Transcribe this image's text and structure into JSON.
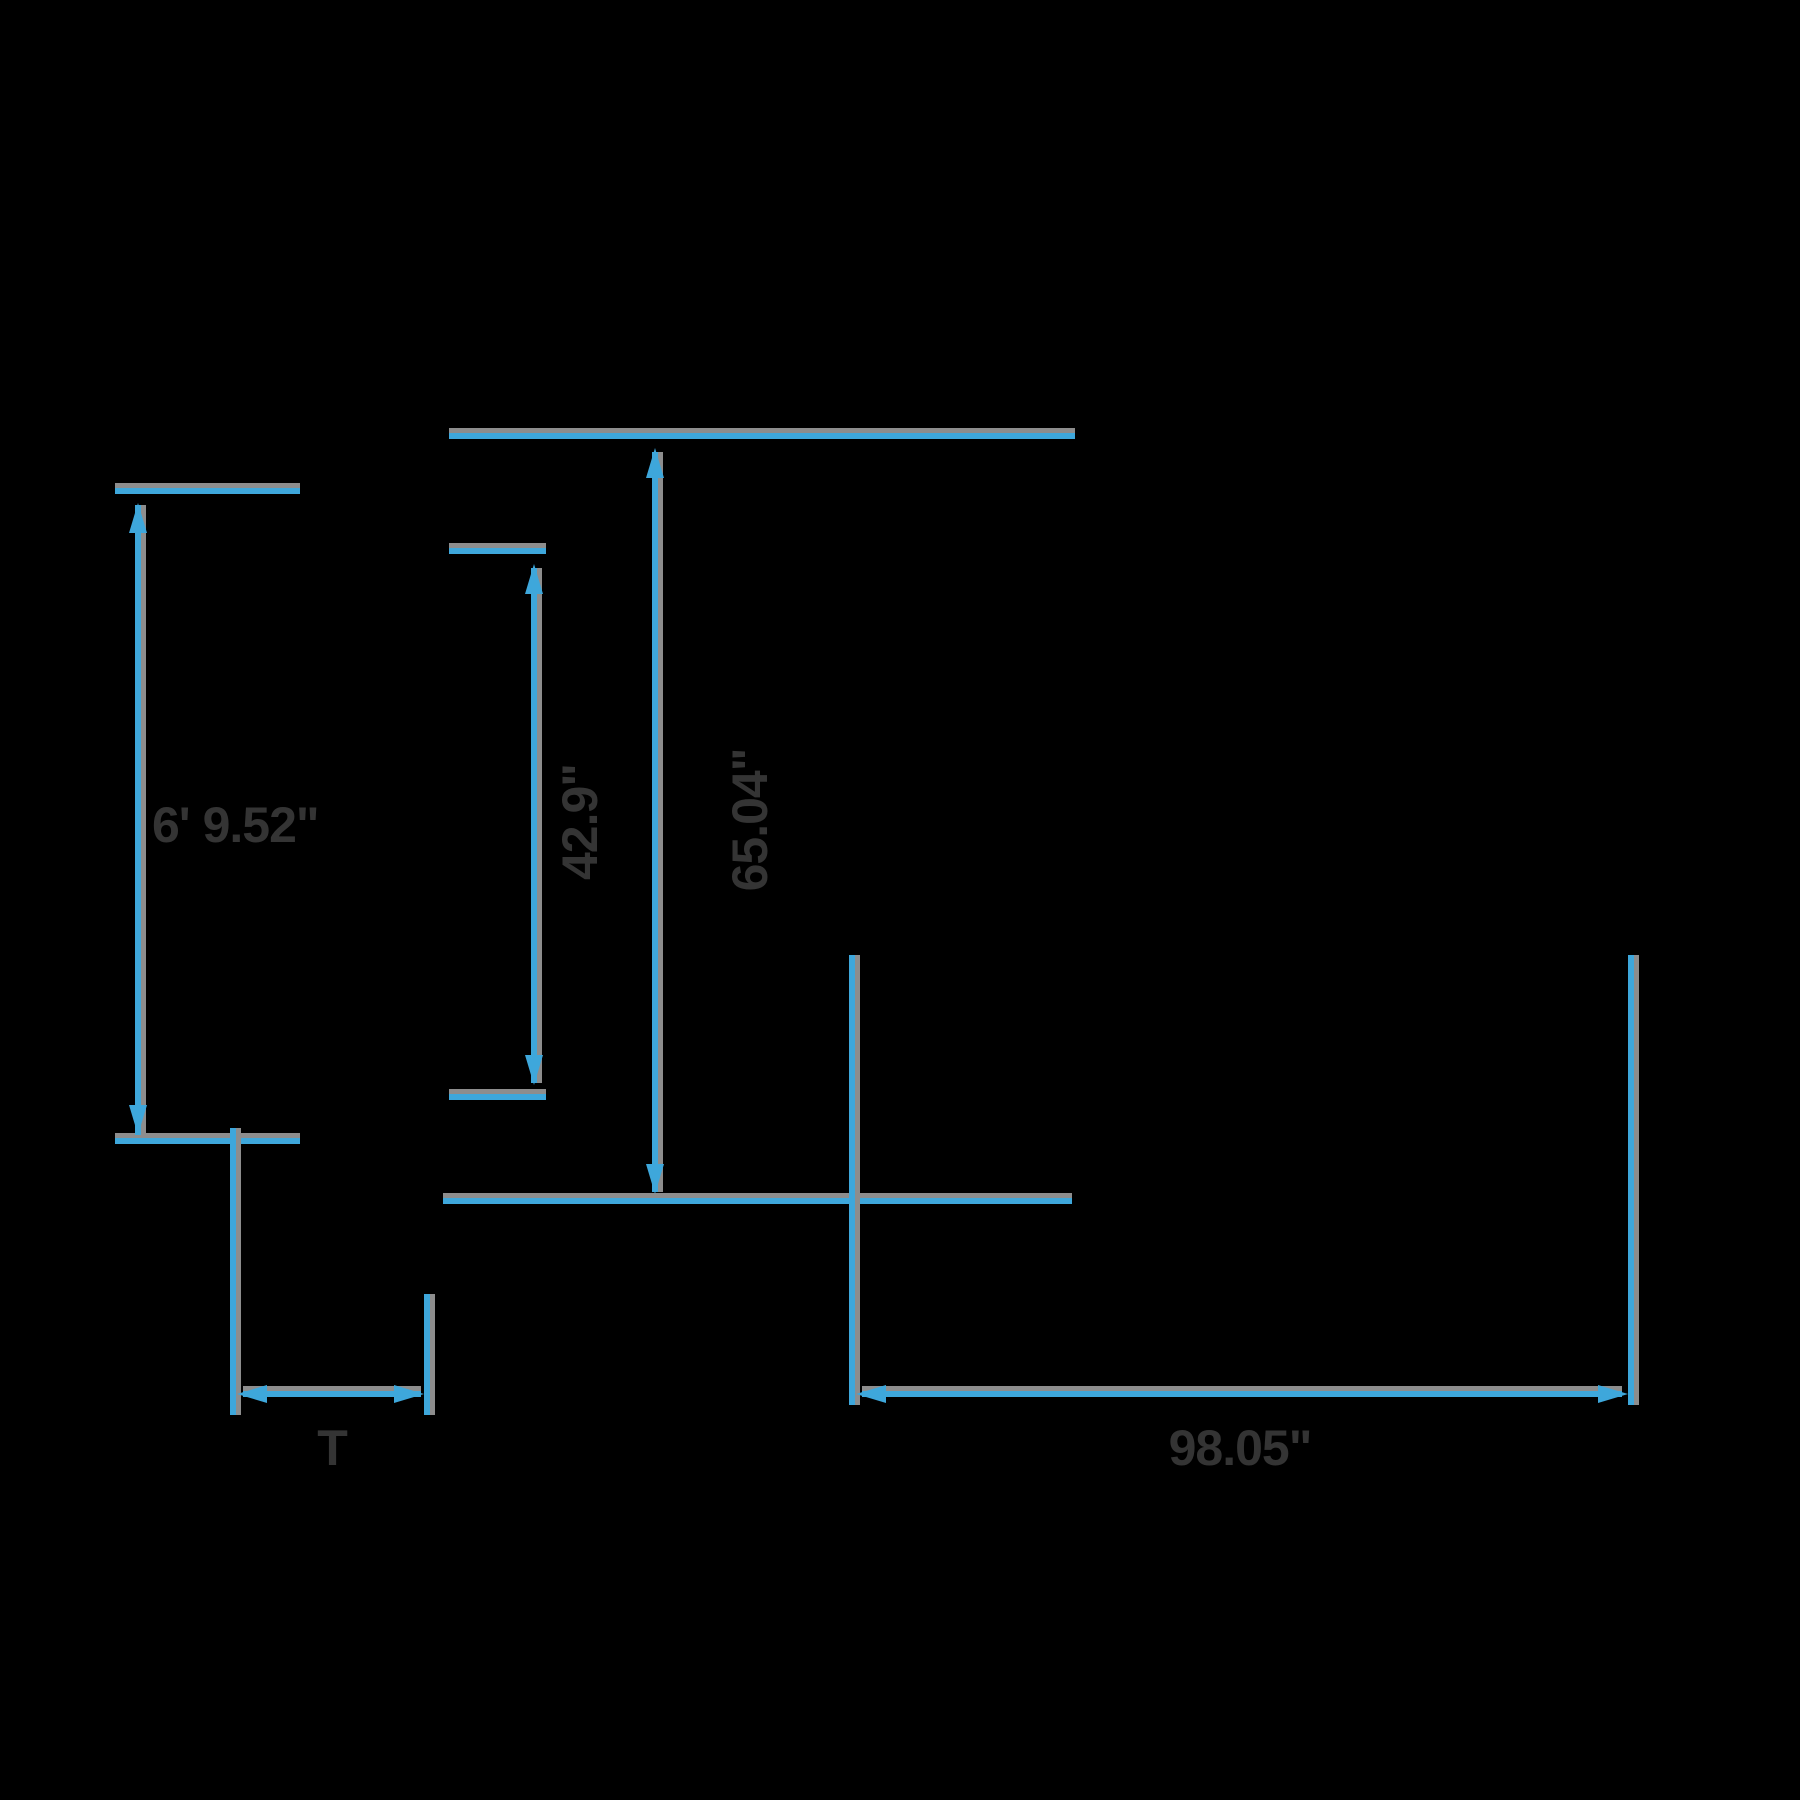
{
  "canvas": {
    "width": 1800,
    "height": 1800,
    "background": "#000000"
  },
  "style": {
    "line_color": "#3EA7DB",
    "shadow_color": "#8D8D8D",
    "label_color": "#343434"
  },
  "labels": {
    "left_height": "6' 9.52\"",
    "inner_height": "42.9\"",
    "overall_height": "65.04\"",
    "bottom_offset": "T",
    "overall_width": "98.05\""
  }
}
